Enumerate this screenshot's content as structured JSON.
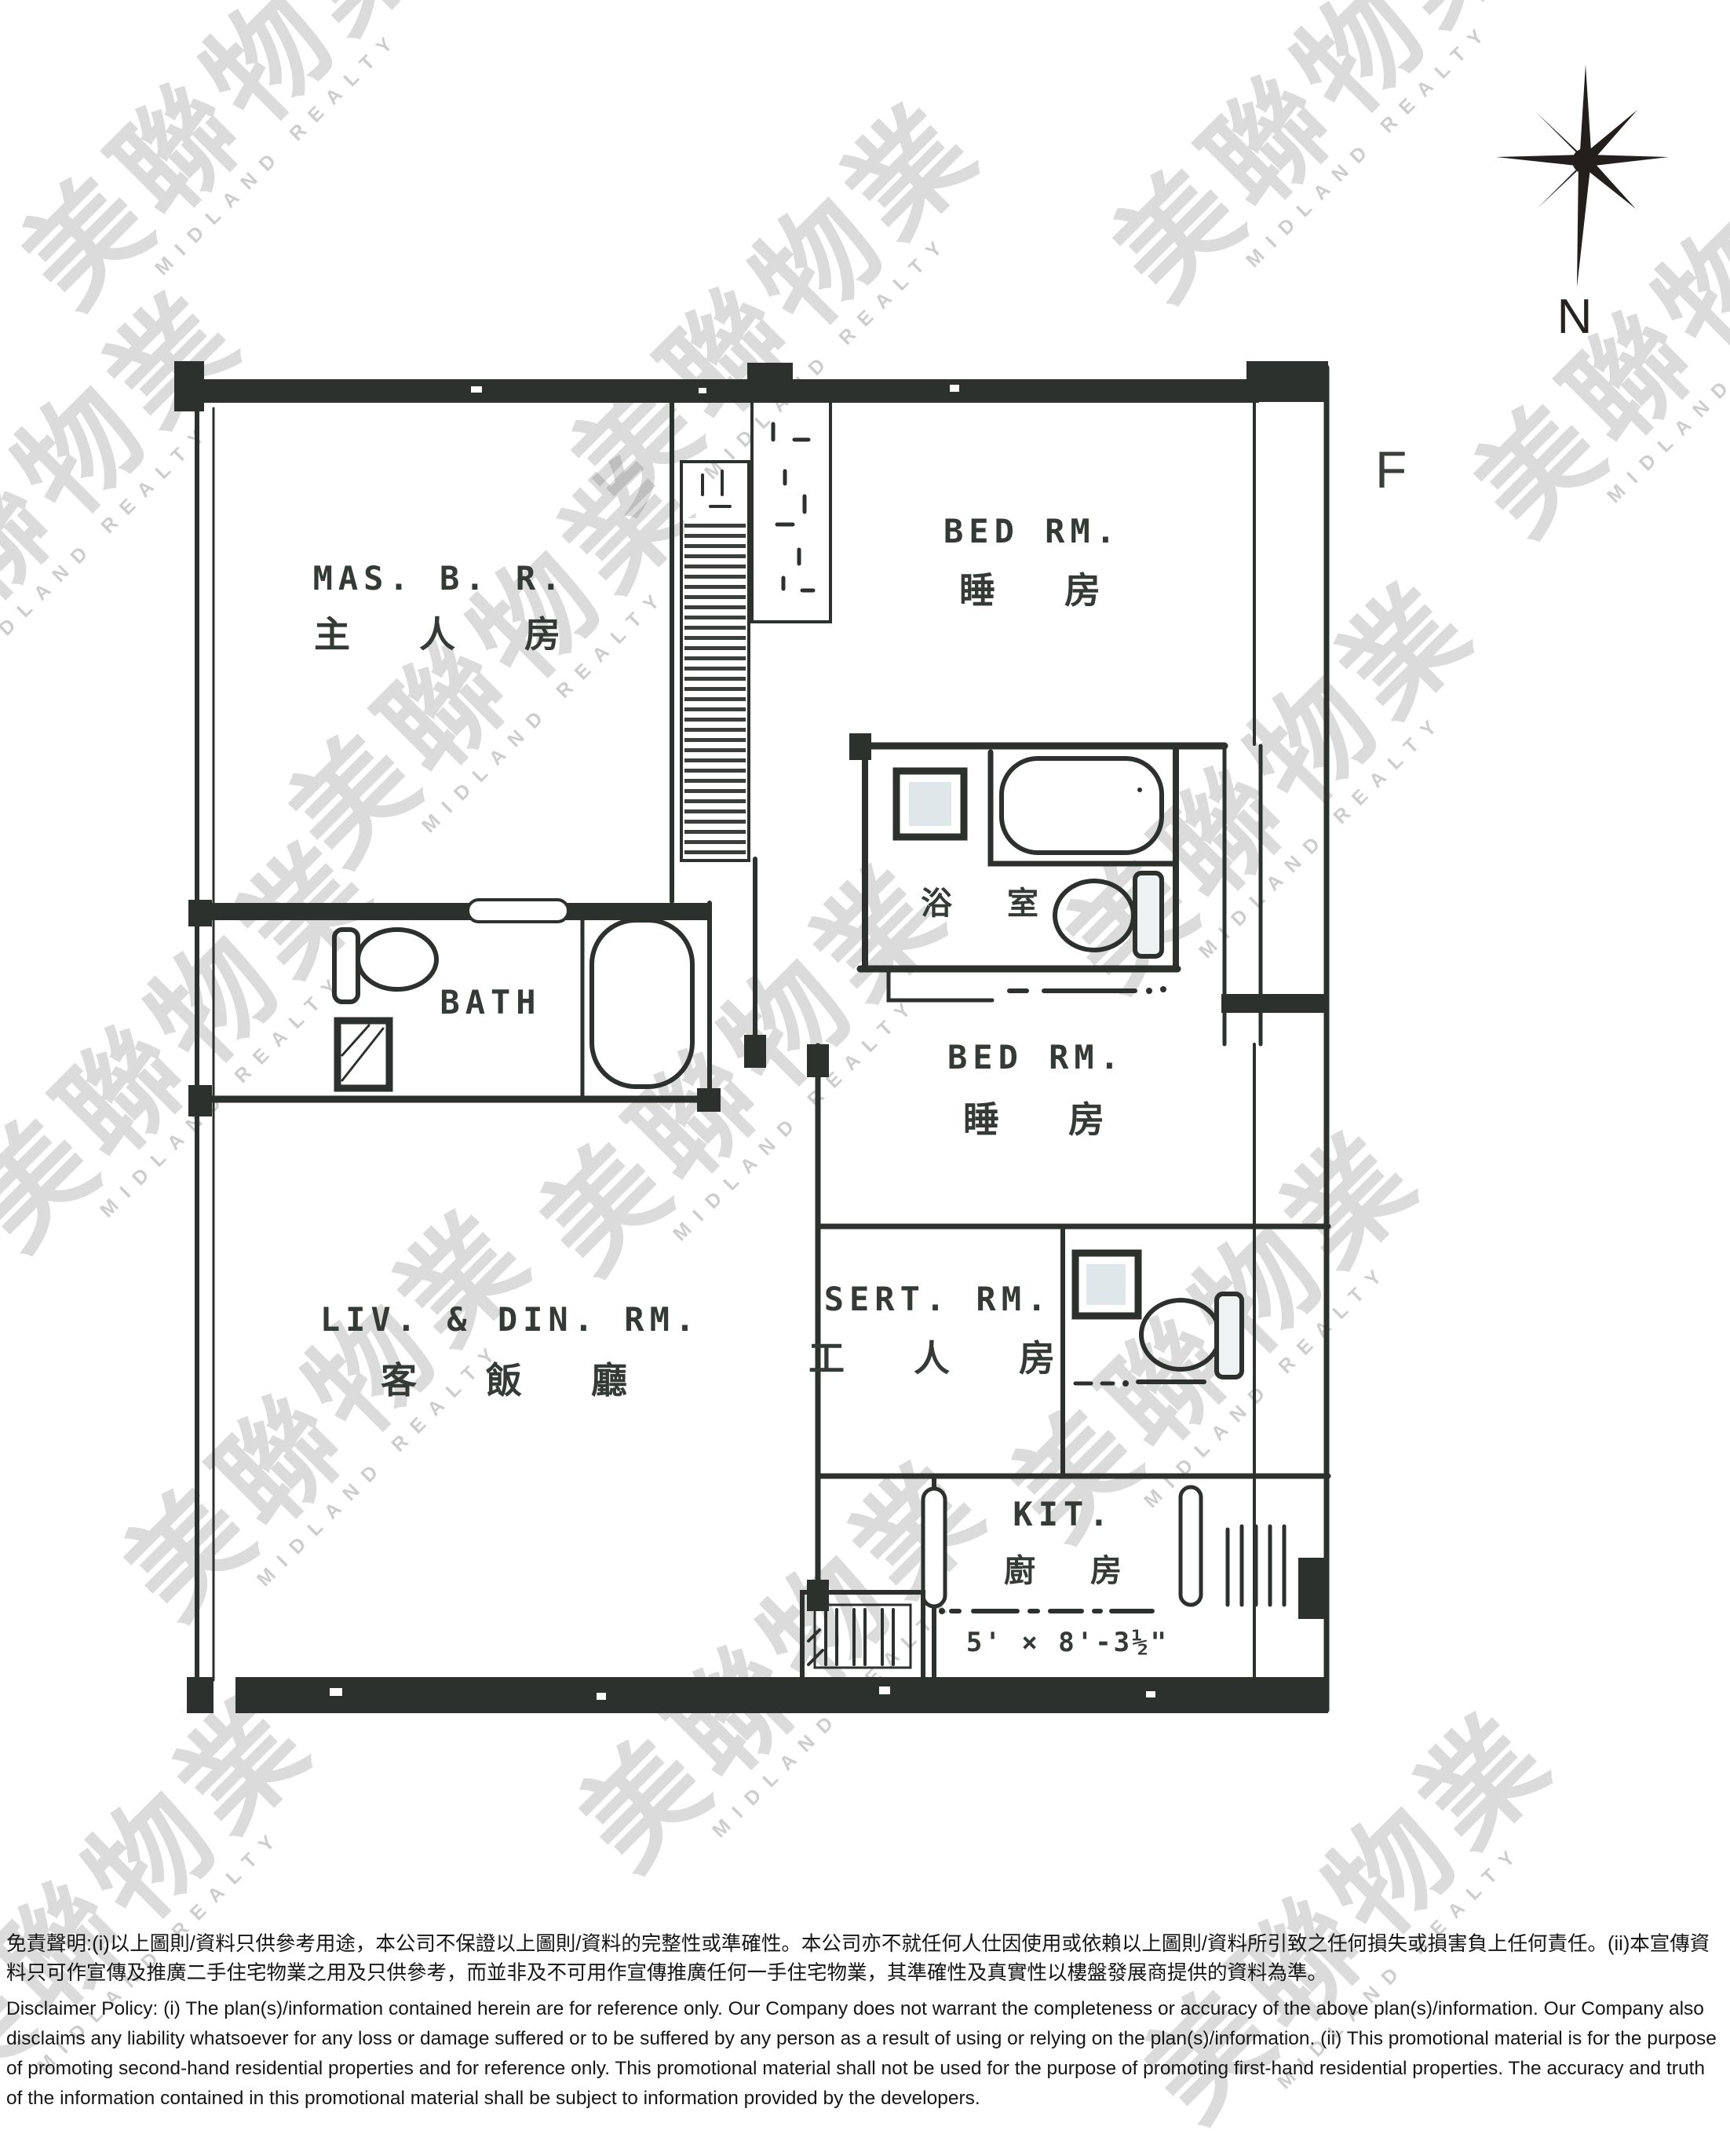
{
  "watermark": {
    "cjk": "美聯物業",
    "latin": "MIDLAND REALTY"
  },
  "compass": {
    "label": "N"
  },
  "flat_label": "F",
  "rooms": {
    "master_bedroom": {
      "en": "MAS. B. R.",
      "zh": "主 人 房"
    },
    "bedroom_top": {
      "en": "BED RM.",
      "zh": "睡 房"
    },
    "bathroom_middle": {
      "zh": "浴 室"
    },
    "bath": {
      "en": "BATH"
    },
    "bedroom_middle": {
      "en": "BED RM.",
      "zh": "睡 房"
    },
    "living_dining": {
      "en": "LIV. & DIN. RM.",
      "zh": "客 飯 廳"
    },
    "servant_room": {
      "en": "SERT. RM.",
      "zh": "工 人 房"
    },
    "kitchen": {
      "en": "KIT.",
      "zh": "廚 房",
      "dimension": "5' × 8'-3½\""
    }
  },
  "colors": {
    "ink": "#2c312d",
    "paper": "#ffffff"
  },
  "disclaimer": {
    "zh": "免責聲明:(i)以上圖則/資料只供參考用途，本公司不保證以上圖則/資料的完整性或準確性。本公司亦不就任何人仕因使用或依賴以上圖則/資料所引致之任何損失或損害負上任何責任。(ii)本宣傳資料只可作宣傳及推廣二手住宅物業之用及只供參考，而並非及不可用作宣傳推廣任何一手住宅物業，其準確性及真實性以樓盤發展商提供的資料為準。",
    "en": "Disclaimer Policy: (i) The plan(s)/information contained herein are for reference only. Our Company does not warrant the completeness or accuracy of the above plan(s)/information. Our Company also disclaims any liability whatsoever for any loss or damage suffered or to be suffered by any person as a result of using or relying on the plan(s)/information. (ii) This promotional material is for the purpose of promoting second-hand residential properties and for reference only. This promotional material shall not be used for the purpose of promoting first-hand residential properties. The accuracy and truth of the information contained in this promotional material shall be subject to information provided by the developers."
  }
}
